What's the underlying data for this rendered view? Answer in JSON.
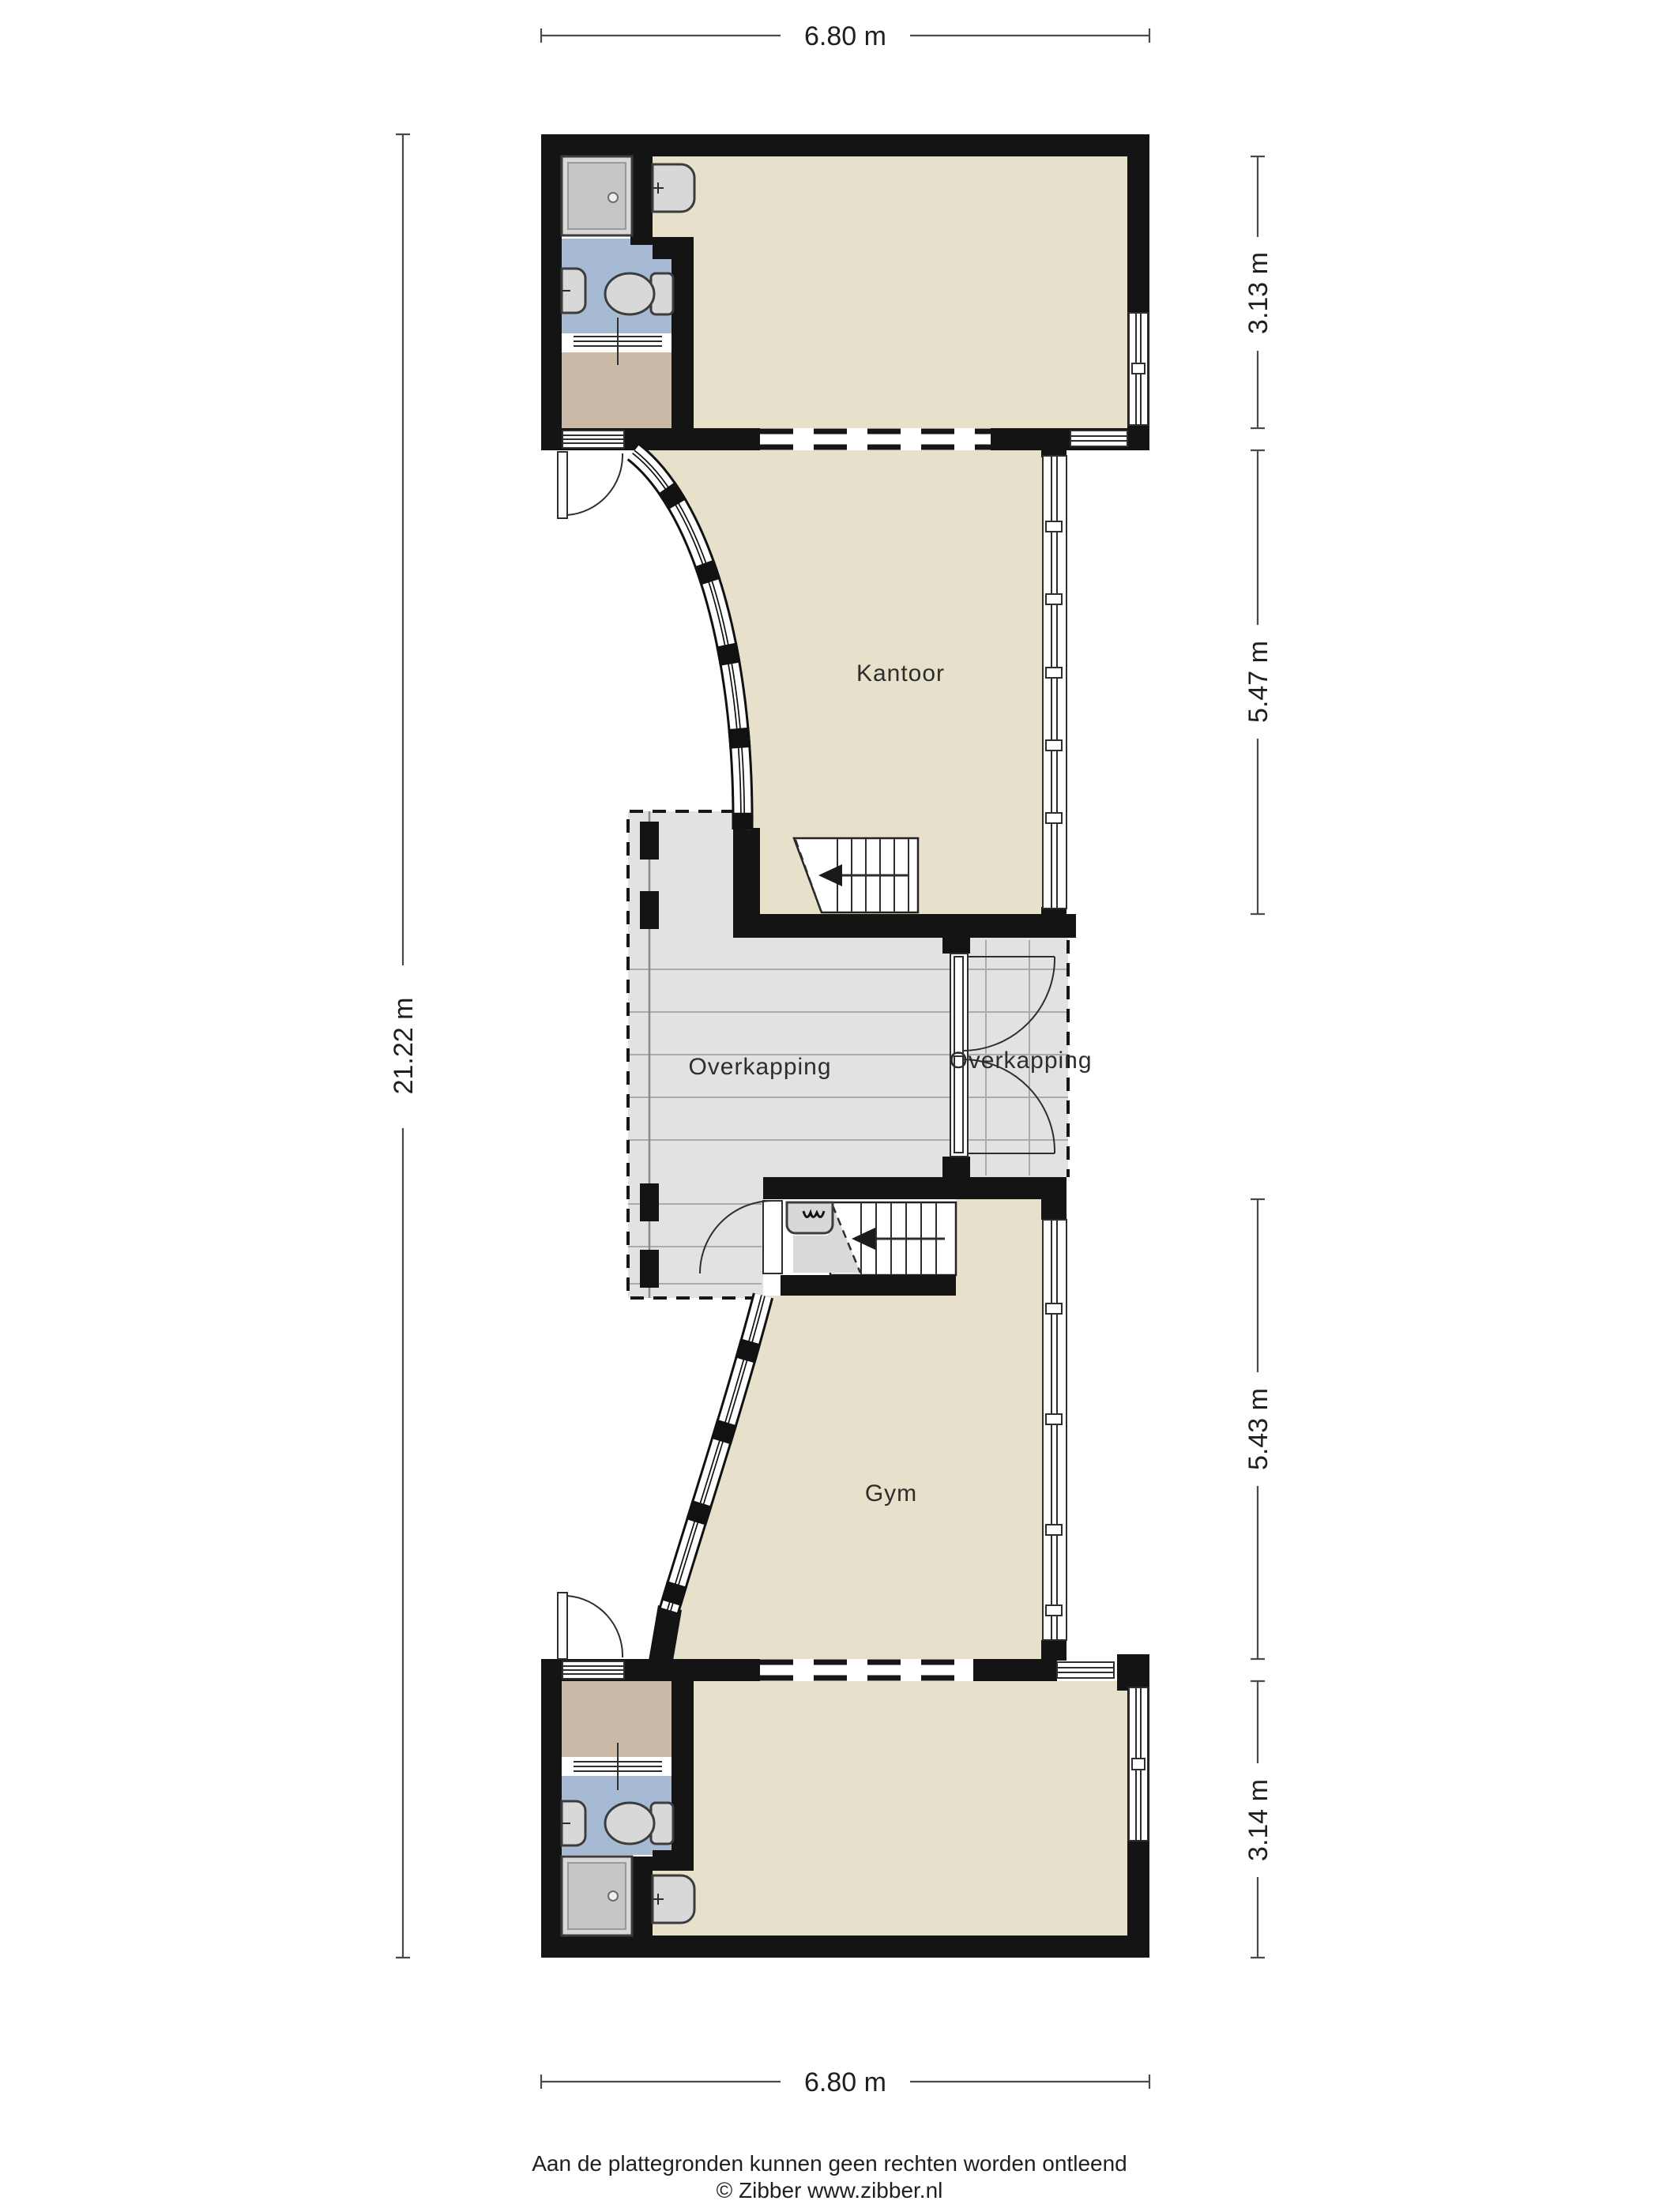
{
  "plan": {
    "type": "floorplan",
    "rooms": {
      "kantoor": "Kantoor",
      "gym": "Gym",
      "overkapping_left": "Overkapping",
      "overkapping_right": "Overkapping"
    },
    "dimensions": {
      "top": "6.80 m",
      "bottom": "6.80 m",
      "left": "21.22 m",
      "right_top_block": "3.13 m",
      "right_kantoor": "5.47 m",
      "right_gym": "5.43 m",
      "right_bottom_block": "3.14 m"
    },
    "footer": {
      "disclaimer": "Aan de plattegronden kunnen geen rechten worden ontleend",
      "credit": "© Zibber www.zibber.nl"
    },
    "colors": {
      "wall": "#141414",
      "floor": "#e7e0ca",
      "hall_floor": "#c9b9a6",
      "bathroom_floor": "#a6bad4",
      "canopy": "#e2e2e2",
      "fixture": "#d8d8d8",
      "shower": "#b5b5b5",
      "dimension": "#4a4a4a"
    }
  }
}
